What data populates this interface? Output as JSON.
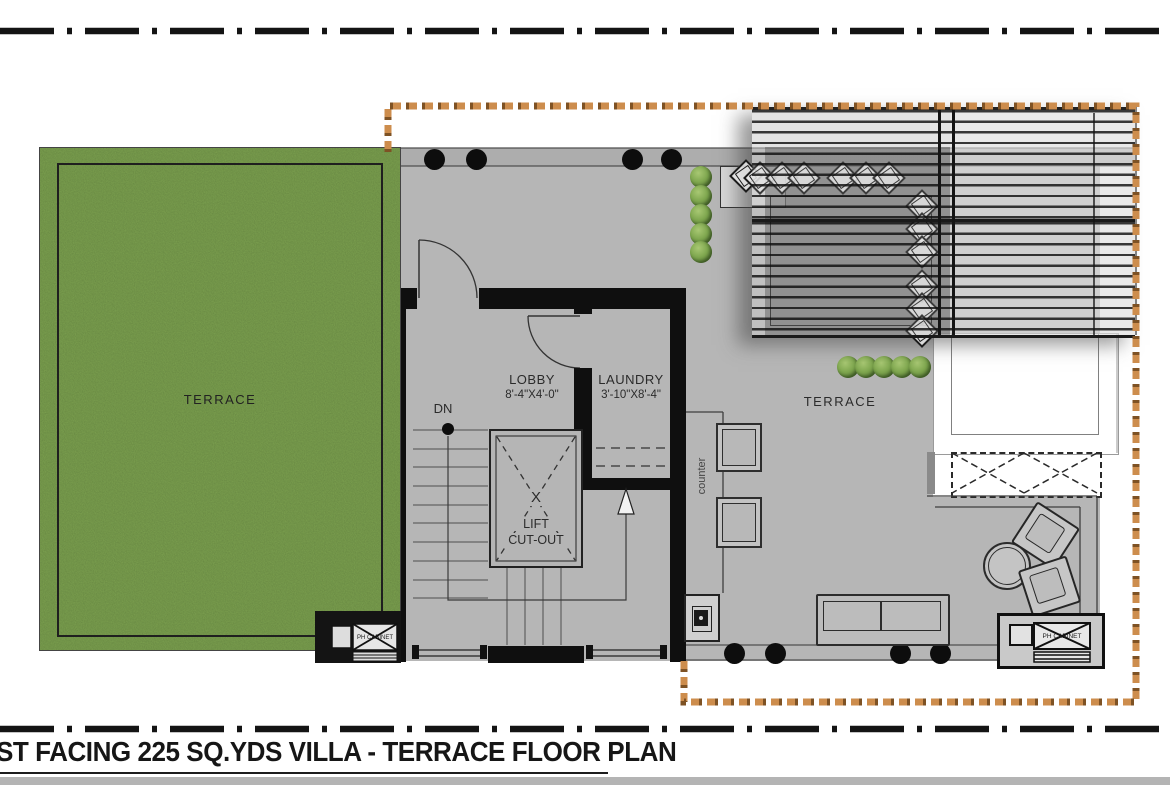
{
  "plan": {
    "title": "ST FACING 225 SQ.YDS VILLA - TERRACE FLOOR PLAN",
    "areas": {
      "terrace_left": {
        "label": "TERRACE"
      },
      "terrace_right": {
        "label": "TERRACE"
      },
      "lobby": {
        "label": "LOBBY",
        "dimensions": "8'-4\"X4'-0\""
      },
      "laundry": {
        "label": "LAUNDRY",
        "dimensions": "3'-10\"X8'-4\""
      },
      "lift": {
        "label_line1": "LIFT",
        "label_line2": "CUT-OUT",
        "cross_mark": "X"
      },
      "stairs": {
        "direction_label": "DN"
      },
      "counter": {
        "label": "counter"
      },
      "utility_left": {
        "label": "PH CABINET"
      },
      "utility_right": {
        "label": "PH CABINET"
      }
    },
    "colors": {
      "site_boundary": "#cd8d4d",
      "site_boundary_dark": "#7e5224",
      "floor": "#b5b5b5",
      "grass": "#7ba04f",
      "wall": "#0f0f0f",
      "frame_dash": "#141414"
    }
  }
}
